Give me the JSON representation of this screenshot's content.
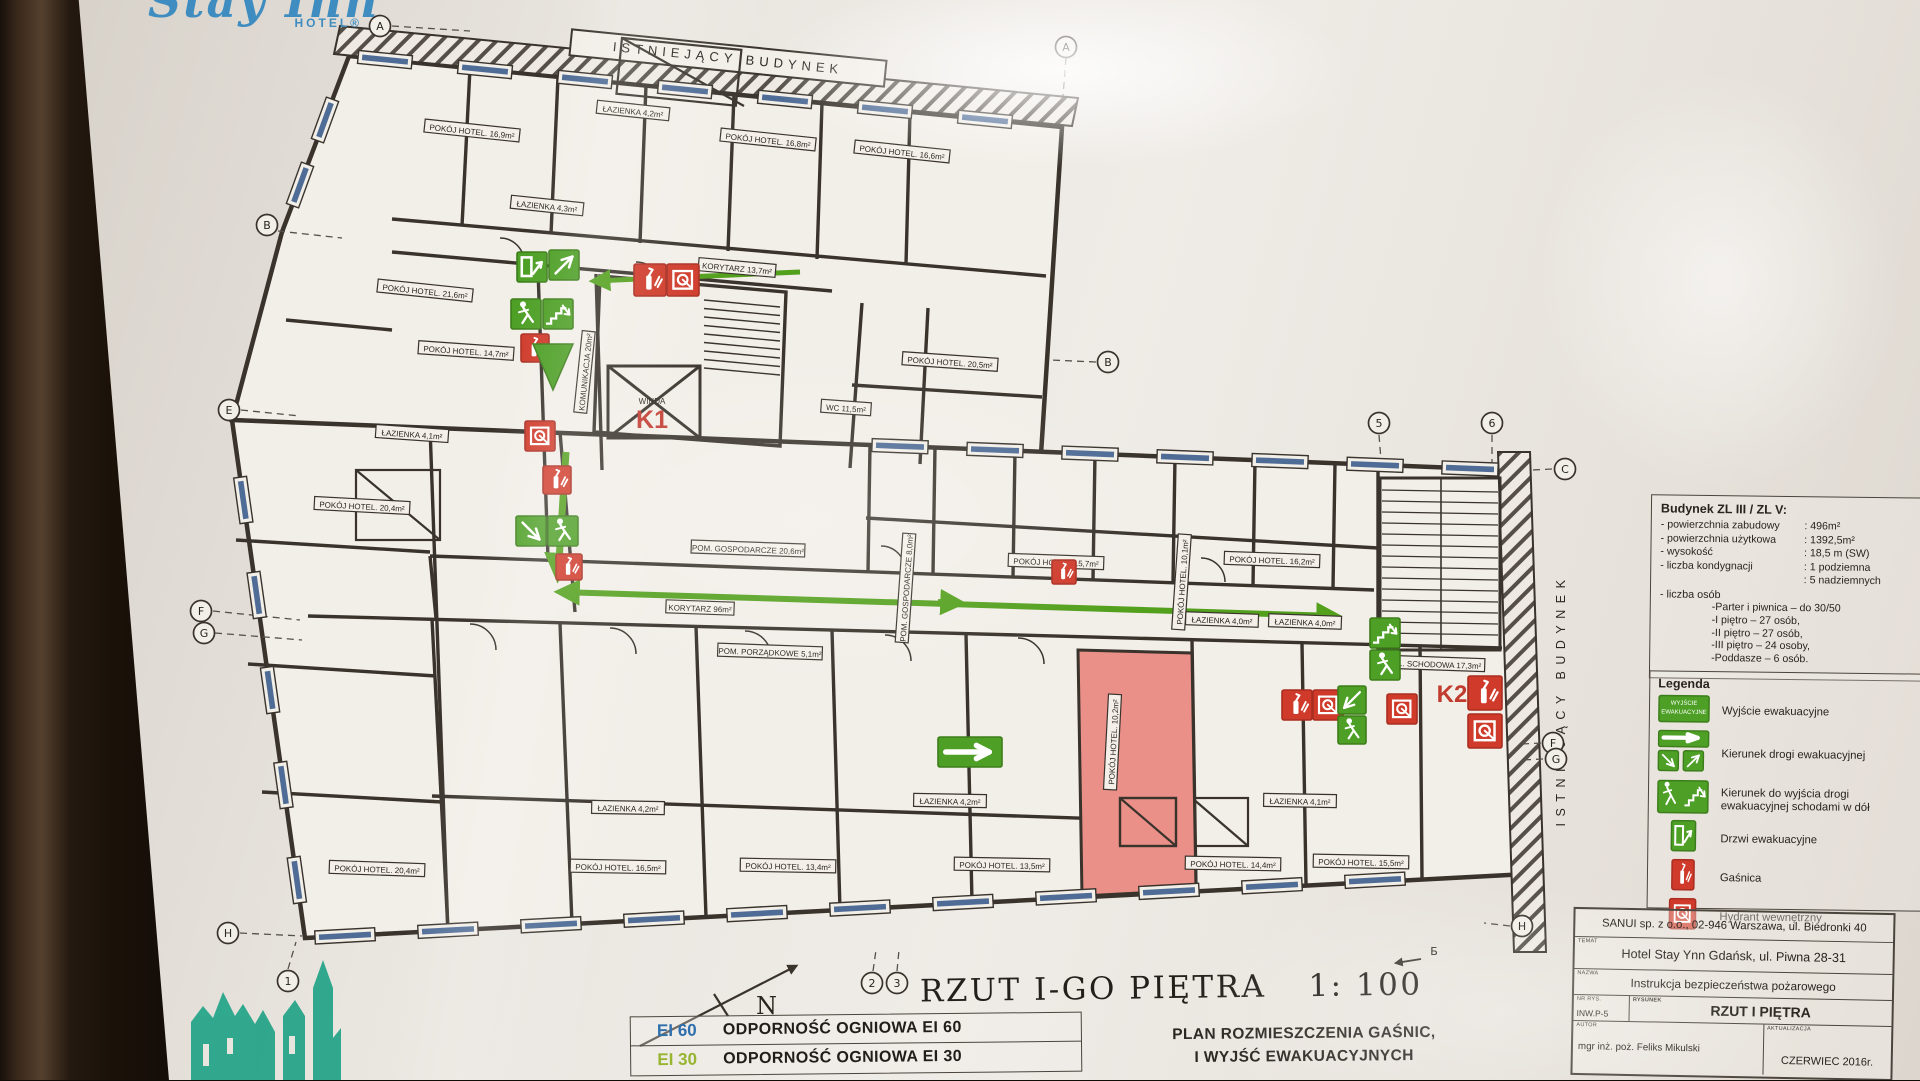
{
  "colors": {
    "evac_green": "#4d9f25",
    "alarm_red": "#cf3a2a",
    "highlight_pink": "#ea9089",
    "window_blue": "#41618e",
    "logo_blue": "#3f8dc0",
    "watermark_teal": "#18a083",
    "ei60_blue": "#2e6fae",
    "ei30_green": "#97b530"
  },
  "logo": {
    "name": "Stay Inn",
    "sub": "HOTEL®"
  },
  "top_banner": "ISTNIEJĄCY BUDYNEK",
  "right_banner": "ISTNIEJĄCY BUDYNEK",
  "floor_title": {
    "text": "RZUT  I-GO PIĘTRA",
    "scale": "1: 100"
  },
  "north_label": "N",
  "plan_subtitle": [
    "PLAN ROZMIESZCZENIA GAŚNIC,",
    "I WYJŚĆ EWAKUACYJNYCH"
  ],
  "fire_resistance": {
    "rows": [
      {
        "code": "EI 60",
        "color": "#2e6fae",
        "label": "ODPORNOŚĆ OGNIOWA EI 60"
      },
      {
        "code": "EI 30",
        "color": "#97b530",
        "label": "ODPORNOŚĆ OGNIOWA EI 30"
      }
    ]
  },
  "building_info": {
    "title": "Budynek ZL III / ZL V:",
    "rows": [
      {
        "label": "- powierzchnia zabudowy",
        "value": ": 496m²"
      },
      {
        "label": "- powierzchnia użytkowa",
        "value": ": 1392,5m²"
      },
      {
        "label": "- wysokość",
        "value": ": 18,5 m (SW)"
      },
      {
        "label": "- liczba kondygnacji",
        "value": ": 1 podziemna"
      },
      {
        "label": "",
        "value": ": 5 nadziemnych"
      }
    ],
    "persons_title": "- liczba osób",
    "persons": [
      "-Parter i piwnica – do 30/50",
      "-I piętro – 27 osób,",
      "-II piętro – 27 osób,",
      "-III piętro – 24 osoby,",
      "-Poddasze – 6 osób."
    ]
  },
  "legend": {
    "title": "Legenda",
    "exit_sign_lines": [
      "WYJŚCIE",
      "EWAKUACYJNE"
    ],
    "items": [
      {
        "icon": "exit-sign",
        "label": "Wyjście ewakuacyjne"
      },
      {
        "icon": "direction-arrows",
        "label": "Kierunek drogi ewakuacyjnej"
      },
      {
        "icon": "stairs-down",
        "label": "Kierunek do wyjścia drogi ewakuacyjnej schodami w dół"
      },
      {
        "icon": "evac-door",
        "label": "Drzwi ewakuacyjne"
      },
      {
        "icon": "extinguisher",
        "label": "Gaśnica"
      },
      {
        "icon": "hydrant",
        "label": "Hydrant wewnętrzny"
      }
    ]
  },
  "title_block": {
    "company": "SANUI sp. z o.o., 02-946 Warszawa, ul. Biedronki 40",
    "object_label": "TEMAT",
    "object": "Hotel Stay Ynn  Gdańsk, ul. Piwna 28-31",
    "doc_label": "NAZWA",
    "doc": "Instrukcja bezpieczeństwa pożarowego",
    "number_label": "NR RYS.",
    "number": "INW.P-5",
    "drawing_label": "RYSUNEK",
    "drawing": "RZUT I PIĘTRA",
    "author_label": "AUTOR",
    "author": "mgr inż. poż. Feliks Mikulski",
    "update_label": "AKTUALIZACJA",
    "update": "CZERWIEC 2016r."
  },
  "plan": {
    "k1": "K1",
    "k1_caption": "WINDA",
    "k2": "K2",
    "section_marker": "Б",
    "room_labels": [
      {
        "text": "POKÓJ HOTEL. 16,9m²",
        "x": 472,
        "y": 131,
        "r": 6
      },
      {
        "text": "ŁAZIENKA 4,2m²",
        "x": 633,
        "y": 111,
        "r": 6
      },
      {
        "text": "POKÓJ HOTEL. 16,8m²",
        "x": 768,
        "y": 140,
        "r": 6
      },
      {
        "text": "POKÓJ HOTEL. 16,6m²",
        "x": 902,
        "y": 152,
        "r": 6
      },
      {
        "text": "ŁAZIENKA 4,3m²",
        "x": 547,
        "y": 206,
        "r": 6
      },
      {
        "text": "POKÓJ HOTEL. 21,6m²",
        "x": 425,
        "y": 291,
        "r": 6
      },
      {
        "text": "KORYTARZ 13,7m²",
        "x": 737,
        "y": 268,
        "r": 5
      },
      {
        "text": "POKÓJ HOTEL. 20,5m²",
        "x": 950,
        "y": 362,
        "r": 4
      },
      {
        "text": "WC 11,5m²",
        "x": 846,
        "y": 408,
        "r": 4
      },
      {
        "text": "POKÓJ HOTEL. 14,7m²",
        "x": 466,
        "y": 351,
        "r": 4
      },
      {
        "text": "ŁAZIENKA 4,1m²",
        "x": 412,
        "y": 434,
        "r": 4
      },
      {
        "text": "KOMUNIKACJA 20m²",
        "x": 585,
        "y": 372,
        "r": -84
      },
      {
        "text": "POKÓJ HOTEL. 20,4m²",
        "x": 362,
        "y": 506,
        "r": 3
      },
      {
        "text": "POM. GOSPODARCZE 20,6m²",
        "x": 748,
        "y": 549,
        "r": 2
      },
      {
        "text": "POM. GOSPODARCZE 8,0m²",
        "x": 906,
        "y": 588,
        "r": -86
      },
      {
        "text": "KORYTARZ 96m²",
        "x": 700,
        "y": 608,
        "r": 2
      },
      {
        "text": "POM. PORZĄDKOWE 5,1m²",
        "x": 770,
        "y": 652,
        "r": 2
      },
      {
        "text": "POKÓJ HOTEL. 15,7m²",
        "x": 1056,
        "y": 562,
        "r": 2
      },
      {
        "text": "POKÓJ HOTEL. 10,1m²",
        "x": 1182,
        "y": 582,
        "r": -86
      },
      {
        "text": "POKÓJ HOTEL. 16,2m²",
        "x": 1272,
        "y": 560,
        "r": 2
      },
      {
        "text": "ŁAZIENKA 4,0m²",
        "x": 1222,
        "y": 620,
        "r": 2
      },
      {
        "text": "ŁAZIENKA 4,0m²",
        "x": 1305,
        "y": 622,
        "r": 2
      },
      {
        "text": "KL. SCHODOWA 17,3m²",
        "x": 1437,
        "y": 664,
        "r": 2
      },
      {
        "text": "ŁAZIENKA 4,2m²",
        "x": 628,
        "y": 808,
        "r": 1
      },
      {
        "text": "ŁAZIENKA 4,2m²",
        "x": 950,
        "y": 801,
        "r": 1
      },
      {
        "text": "ŁAZIENKA 4,1m²",
        "x": 1300,
        "y": 801,
        "r": 1
      },
      {
        "text": "POKÓJ HOTEL. 10,2m²",
        "x": 1113,
        "y": 742,
        "r": -87
      },
      {
        "text": "POKÓJ HOTEL. 20,4m²",
        "x": 377,
        "y": 869,
        "r": 2
      },
      {
        "text": "POKÓJ HOTEL. 16,5m²",
        "x": 618,
        "y": 867,
        "r": 1
      },
      {
        "text": "POKÓJ HOTEL. 13,4m²",
        "x": 788,
        "y": 866,
        "r": 1
      },
      {
        "text": "POKÓJ HOTEL. 13,5m²",
        "x": 1002,
        "y": 865,
        "r": 1
      },
      {
        "text": "POKÓJ HOTEL. 14,4m²",
        "x": 1233,
        "y": 864,
        "r": 1
      },
      {
        "text": "POKÓJ HOTEL. 15,5m²",
        "x": 1361,
        "y": 862,
        "r": 1
      }
    ],
    "grid_bubbles": [
      {
        "label": "A",
        "x": 380,
        "y": 26
      },
      {
        "label": "A",
        "x": 1066,
        "y": 47
      },
      {
        "label": "B",
        "x": 267,
        "y": 225
      },
      {
        "label": "B",
        "x": 1108,
        "y": 362
      },
      {
        "label": "E",
        "x": 229,
        "y": 410
      },
      {
        "label": "F",
        "x": 201,
        "y": 611
      },
      {
        "label": "G",
        "x": 204,
        "y": 633
      },
      {
        "label": "H",
        "x": 228,
        "y": 933
      },
      {
        "label": "1",
        "x": 288,
        "y": 981
      },
      {
        "label": "2",
        "x": 872,
        "y": 983
      },
      {
        "label": "3",
        "x": 897,
        "y": 983
      },
      {
        "label": "5",
        "x": 1379,
        "y": 423
      },
      {
        "label": "6",
        "x": 1492,
        "y": 423
      },
      {
        "label": "C",
        "x": 1565,
        "y": 469
      },
      {
        "label": "F",
        "x": 1553,
        "y": 743
      },
      {
        "label": "G",
        "x": 1556,
        "y": 759
      },
      {
        "label": "H",
        "x": 1522,
        "y": 926
      },
      {
        "label": "Б",
        "x": 1434,
        "y": 951,
        "plain": true
      }
    ],
    "safety_icons": [
      {
        "type": "door",
        "x": 517,
        "y": 252,
        "s": 30
      },
      {
        "type": "arrow",
        "x": 549,
        "y": 250,
        "s": 30,
        "dir": "ne"
      },
      {
        "type": "ext",
        "x": 634,
        "y": 264,
        "s": 32
      },
      {
        "type": "hyd",
        "x": 667,
        "y": 264,
        "s": 32
      },
      {
        "type": "man",
        "x": 511,
        "y": 299,
        "s": 30
      },
      {
        "type": "stairs",
        "x": 543,
        "y": 299,
        "s": 30
      },
      {
        "type": "ext",
        "x": 521,
        "y": 334,
        "s": 28
      },
      {
        "type": "tri",
        "x": 533,
        "y": 344,
        "w": 40,
        "h": 46
      },
      {
        "type": "hyd",
        "x": 525,
        "y": 421,
        "s": 30
      },
      {
        "type": "ext",
        "x": 543,
        "y": 466,
        "s": 28
      },
      {
        "type": "arrow",
        "x": 516,
        "y": 516,
        "s": 30,
        "dir": "se"
      },
      {
        "type": "man",
        "x": 548,
        "y": 516,
        "s": 30
      },
      {
        "type": "ext",
        "x": 556,
        "y": 554,
        "s": 26
      },
      {
        "type": "arrowR",
        "x": 938,
        "y": 737,
        "w": 64,
        "h": 30
      },
      {
        "type": "ext",
        "x": 1052,
        "y": 560,
        "s": 24
      },
      {
        "type": "ext",
        "x": 1282,
        "y": 690,
        "s": 30
      },
      {
        "type": "hyd",
        "x": 1313,
        "y": 690,
        "s": 30
      },
      {
        "type": "stairs",
        "x": 1370,
        "y": 618,
        "s": 30
      },
      {
        "type": "man",
        "x": 1370,
        "y": 650,
        "s": 30
      },
      {
        "type": "arrow",
        "x": 1338,
        "y": 686,
        "s": 28,
        "dir": "sw"
      },
      {
        "type": "man",
        "x": 1338,
        "y": 716,
        "s": 28
      },
      {
        "type": "hyd",
        "x": 1387,
        "y": 694,
        "s": 30
      },
      {
        "type": "ext",
        "x": 1468,
        "y": 676,
        "s": 34
      },
      {
        "type": "hyd",
        "x": 1468,
        "y": 714,
        "s": 34
      }
    ]
  }
}
